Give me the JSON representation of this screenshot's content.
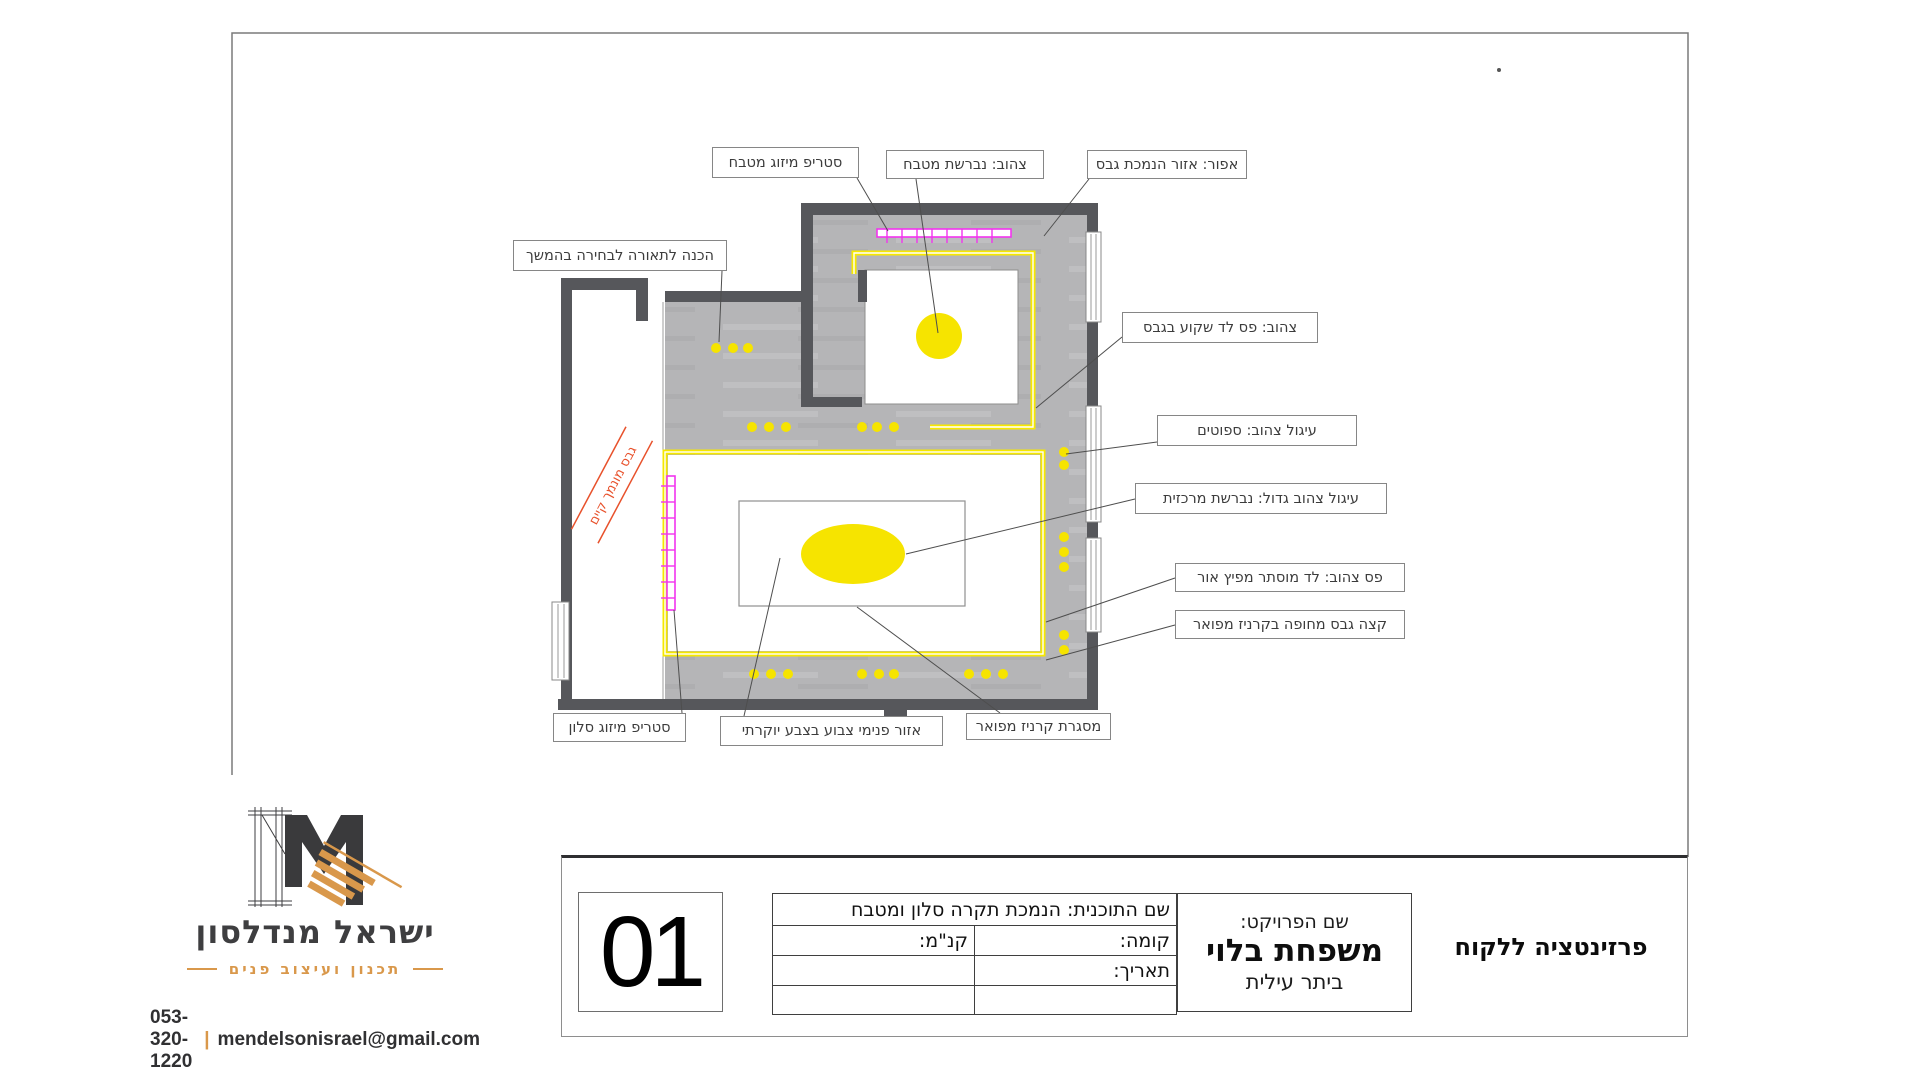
{
  "colors": {
    "wall": "#56575b",
    "soffit_gray": "#b5b5b7",
    "accent_yellow": "#f6e800",
    "accent_magenta": "#f234ee",
    "note_red": "#e8512b",
    "logo_orange": "#d9984b",
    "logo_dark": "#3e3e40"
  },
  "plan": {
    "annotations": [
      {
        "id": "strip-ac-kitchen",
        "text": "סטריפ מיזוג מטבח"
      },
      {
        "id": "yellow-kitchen-chandelier",
        "text": "צהוב: נברשת מטבח"
      },
      {
        "id": "gray-gypsum-area",
        "text": "אפור: אזור הנמכת גבס"
      },
      {
        "id": "lighting-prep",
        "text": "הכנה לתאורה לבחירה בהמשך"
      },
      {
        "id": "yellow-led-strip",
        "text": "צהוב: פס לד שקוע בגבס"
      },
      {
        "id": "yellow-circle-spots",
        "text": "עיגול צהוב: ספוטים"
      },
      {
        "id": "big-yellow-circle",
        "text": "עיגול צהוב גדול: נברשת מרכזית"
      },
      {
        "id": "yellow-strip-hidden-led",
        "text": "פס צהוב: לד מוסתר מפיץ אור"
      },
      {
        "id": "gypsum-edge-cornice",
        "text": "קצה גבס מחופה בקרניז מפואר"
      },
      {
        "id": "strip-ac-living",
        "text": "סטריפ מיזוג סלון"
      },
      {
        "id": "inner-painted-area",
        "text": "אזור פנימי צבוע בצבע יוקרתי"
      },
      {
        "id": "cornice-frame",
        "text": "מסגרת קרניז מפואר"
      }
    ],
    "diagonal_note": "גבס מונמך קיים"
  },
  "title_block": {
    "sheet_number": "01",
    "plan_name": "שם התוכנית: הנמכת תקרה סלון ומטבח",
    "floor_label": "קומה:",
    "scale_label": "קנ\"מ:",
    "date_label": "תאריך:",
    "project_label": "שם הפרויקט:",
    "project_name": "משפחת בלוי",
    "project_location": "ביתר עילית",
    "presentation_title": "פרזינטציה ללקוח"
  },
  "logo": {
    "monogram": "M",
    "name": "ישראל מנדלסון",
    "tagline": "תכנון ועיצוב פנים",
    "phone": "053-320-1220",
    "separator": "|",
    "email": "mendelsonisrael@gmail.com"
  }
}
